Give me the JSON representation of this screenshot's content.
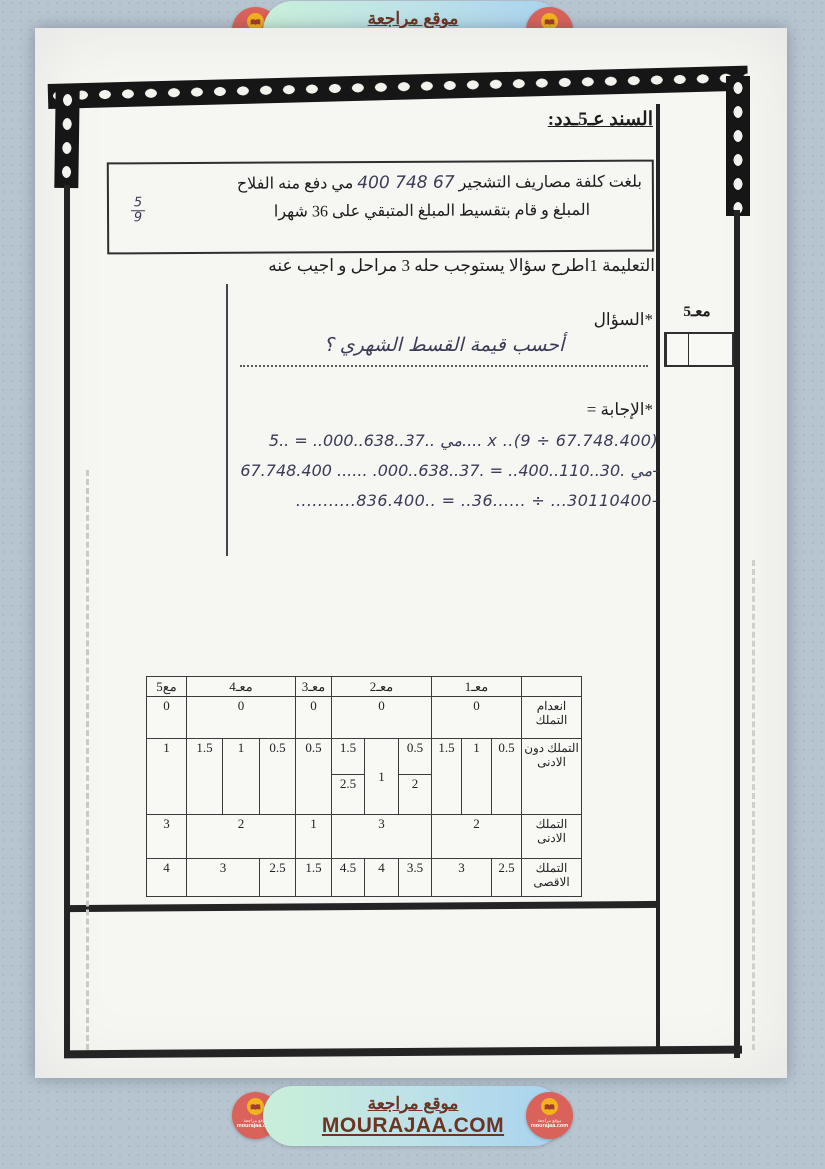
{
  "banner": {
    "title_ar": "موقع مراجعة",
    "domain": "MOURAJAA.COM",
    "badge": {
      "line1": "موقع مراجعة",
      "line2": "mourajaa.com"
    },
    "colors": {
      "pill_green": "#c9efd9",
      "pill_blue": "#a8d2f0",
      "badge_red": "#d9635a",
      "badge_yellow": "#f2b31d",
      "text_brown": "#6d3423"
    }
  },
  "document": {
    "title": "السند عـ5ـدد:",
    "problem": {
      "line1_prefix": "بلغت كلفة  مصاريف التشجير",
      "amount_handwritten": "67 748 400",
      "line1_suffix": "مي دفع منه الفلاح",
      "fraction_numerator": "5",
      "fraction_denominator": "9",
      "line2": "المبلغ و قام بتقسيط المبلغ المتبقي على 36 شهرا"
    },
    "instruction": "التعليمة 1اطرح سؤالا يستوجب حله 3 مراحل و اجيب عنه",
    "question_label": "*السؤال",
    "score_label": "معـ5",
    "question_handwritten": "أحسب قيمة القسط الشهري ؟",
    "answer_label": "*الإجابة =",
    "answer_line1": "مي ..37..638..000.. = ..5.... x ..(9 ÷ 67.748.400)",
    "answer_line2": "مي .30..110..400.. = .37..638..000. ...... 67.748.400-",
    "answer_line3": "...........836.400.. = ..36...... ÷ ...30110400-"
  },
  "grading_table": {
    "headers": {
      "m1": "معـ1",
      "m2": "معـ2",
      "m3": "معـ3",
      "m4": "معـ4",
      "m5": "مع5"
    },
    "row_labels": {
      "r1": "انعدام التملك",
      "r2": "التملك دون الادنى",
      "r3": "التملك الادنى",
      "r4": "التملك الاقصى"
    },
    "r1": {
      "m1": "0",
      "m2": "0",
      "m3": "0",
      "m4": "0",
      "m5": "0"
    },
    "r2": {
      "m1": [
        "0.5",
        "1",
        "1.5"
      ],
      "m2_top_r": "0.5",
      "m2_mid": "1",
      "m2_top_l": "1.5",
      "m2_bot_r": "2",
      "m2_bot_l": "2.5",
      "m3": "0.5",
      "m4": [
        "0.5",
        "1",
        "1.5"
      ],
      "m5": "1"
    },
    "r3": {
      "m1": "2",
      "m2": "3",
      "m3": "1",
      "m4": "2",
      "m5": "3"
    },
    "r4": {
      "m1": [
        "2.5",
        "3"
      ],
      "m2": [
        "3.5",
        "4",
        "4.5"
      ],
      "m3": "1.5",
      "m4": [
        "2.5",
        "3"
      ],
      "m5": "4"
    }
  }
}
